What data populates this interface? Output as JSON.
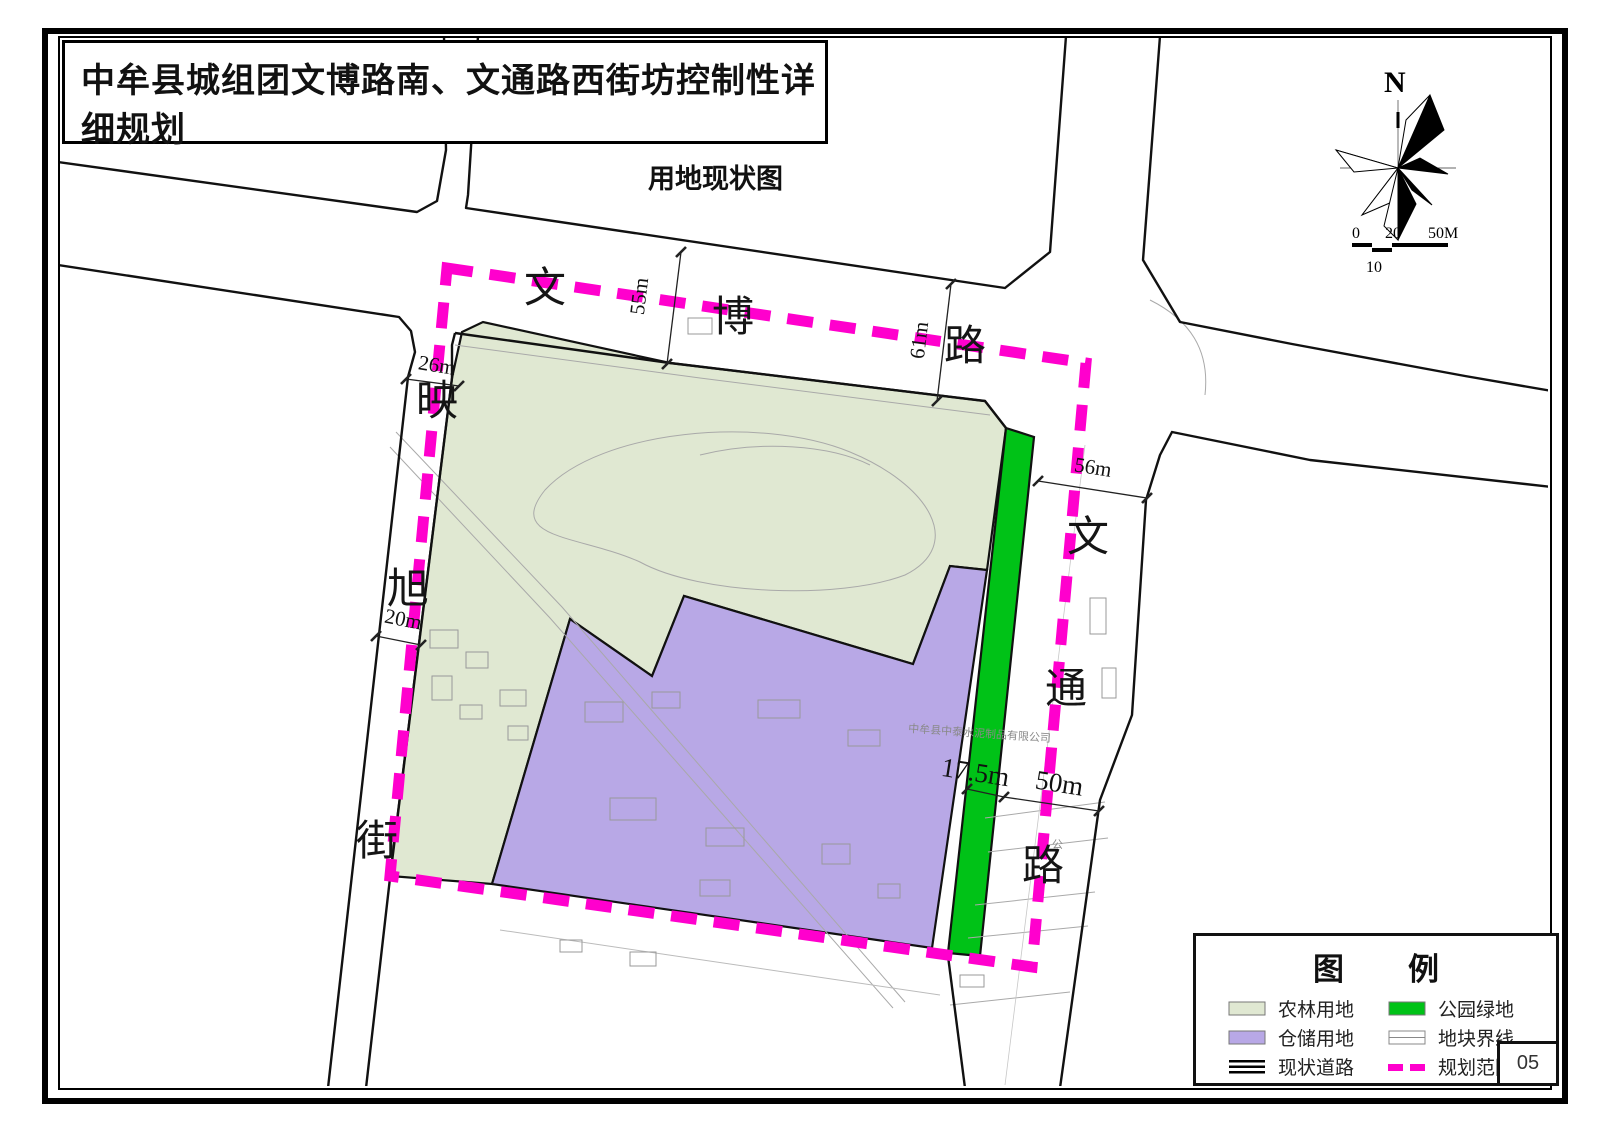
{
  "title_block": {
    "title": "中牟县城组团文博路南、文通路西街坊控制性详细规划",
    "subtitle": "用地现状图"
  },
  "north_arrow": {
    "label": "N"
  },
  "scale_bar": {
    "labels_top": [
      "0",
      "20",
      "50M"
    ],
    "label_bottom": "10"
  },
  "roads": {
    "wenbo": {
      "name": "文博路",
      "chars": [
        "文",
        "博",
        "路"
      ]
    },
    "yingxu": {
      "name": "映旭街",
      "chars": [
        "映",
        "旭",
        "街"
      ]
    },
    "wentong": {
      "name": "文通路",
      "chars": [
        "文",
        "通",
        "路"
      ]
    }
  },
  "dimensions": {
    "yingxu_north": "26m",
    "yingxu_south": "20m",
    "wenbo_west": "55m",
    "wenbo_east": "61m",
    "wentong_north": "56m",
    "park_width": "17.5m",
    "wentong_south": "50m"
  },
  "annotations": {
    "company_name": "中牟县中泰水泥制品有限公司",
    "road_side_note": "公"
  },
  "legend": {
    "title_chars": [
      "图",
      "例"
    ],
    "items": [
      {
        "label": "农林用地",
        "type": "fill",
        "color": "#e0e8d2"
      },
      {
        "label": "仓储用地",
        "type": "fill",
        "color": "#b8a8e6"
      },
      {
        "label": "现状道路",
        "type": "road-lines",
        "color": "#000000"
      },
      {
        "label": "公园绿地",
        "type": "fill",
        "color": "#00c217"
      },
      {
        "label": "地块界线",
        "type": "parcel-line",
        "color": "#888888"
      },
      {
        "label": "规划范围",
        "type": "dash",
        "color": "#ff00cd"
      }
    ]
  },
  "page": {
    "number": "05"
  },
  "colors": {
    "farmland": "#e0e8d2",
    "warehouse": "#b8a8e6",
    "park": "#00c217",
    "boundary": "#ff00cd",
    "road_line": "#111111"
  }
}
